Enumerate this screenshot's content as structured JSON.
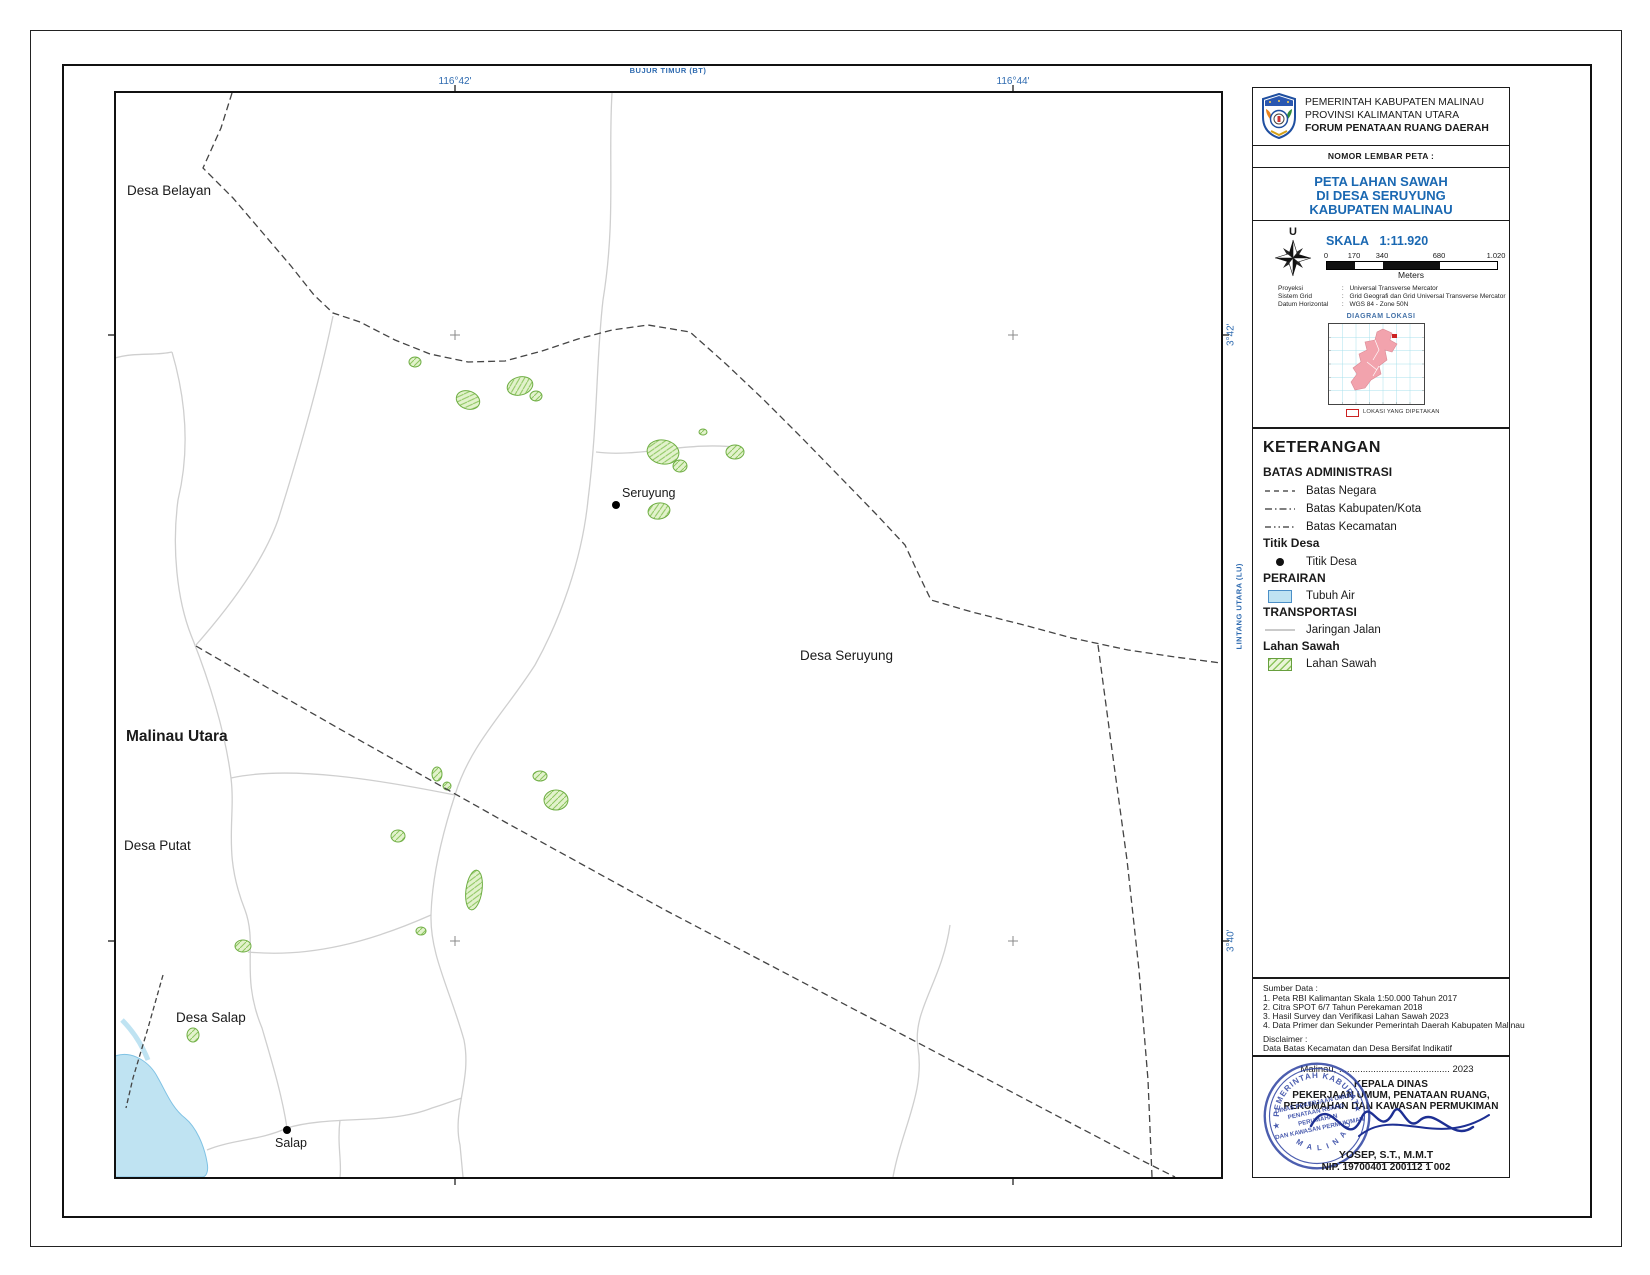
{
  "colors": {
    "title_blue": "#1a68b2",
    "coord_blue": "#2f6bb0",
    "paddy_green": "#7ab648",
    "paddy_fill": "#e2f2cc",
    "water_blue": "#bfe3f2",
    "boundary_gray": "#4a4a4a",
    "road_gray": "#cfcfcf",
    "inset_pink": "#f2a3ad",
    "stamp_blue": "#3448a5",
    "signature_navy": "#1d2f93"
  },
  "axes": {
    "top_label": "BUJUR TIMUR (BT)",
    "right_label": "LINTANG UTARA (LU)",
    "lon_ticks": [
      "116°42'",
      "116°44'"
    ],
    "lat_ticks": [
      "3°42'",
      "3°40'"
    ]
  },
  "map_labels": {
    "desa_belayan": "Desa Belayan",
    "seruyung_point": "Seruyung",
    "desa_seruyung": "Desa Seruyung",
    "malinau_utara": "Malinau Utara",
    "desa_putat": "Desa Putat",
    "desa_salap": "Desa Salap",
    "salap_point": "Salap"
  },
  "header": {
    "agency_line1": "PEMERINTAH KABUPATEN MALINAU",
    "agency_line2": "PROVINSI KALIMANTAN UTARA",
    "agency_line3": "FORUM PENATAAN RUANG DAERAH",
    "sheet_number_label": "NOMOR LEMBAR PETA :"
  },
  "title": {
    "line1": "PETA LAHAN SAWAH",
    "line2": "DI DESA SERUYUNG",
    "line3": "KABUPATEN MALINAU"
  },
  "scale": {
    "north_label": "U",
    "skala_label": "SKALA",
    "skala_value": "1:11.920",
    "bar_ticks": [
      "0",
      "170",
      "340",
      "680",
      "1.020"
    ],
    "unit": "Meters"
  },
  "projection": {
    "separator": ":",
    "rows": [
      {
        "label": "Proyeksi",
        "value": "Universal Transverse Mercator"
      },
      {
        "label": "Sistem Grid",
        "value": "Grid Geografi dan Grid Universal Transverse Mercator"
      },
      {
        "label": "Datum Horizontal",
        "value": "WGS 84 - Zone 50N"
      }
    ]
  },
  "inset": {
    "title": "DIAGRAM LOKASI",
    "legend_label": "LOKASI YANG DIPETAKAN"
  },
  "legend": {
    "title": "KETERANGAN",
    "admin_heading": "BATAS ADMINISTRASI",
    "batas_negara": "Batas Negara",
    "batas_kabupaten": "Batas Kabupaten/Kota",
    "batas_kecamatan": "Batas Kecamatan",
    "titik_desa_heading": "Titik Desa",
    "titik_desa": "Titik Desa",
    "perairan_heading": "PERAIRAN",
    "tubuh_air": "Tubuh Air",
    "transportasi_heading": "TRANSPORTASI",
    "jaringan_jalan": "Jaringan Jalan",
    "lahan_sawah_heading": "Lahan Sawah",
    "lahan_sawah": "Lahan Sawah"
  },
  "sources": {
    "title": "Sumber Data :",
    "items": [
      "1. Peta RBI Kalimantan Skala 1:50.000 Tahun 2017",
      "2. Citra SPOT 6/7 Tahun Perekaman 2018",
      "3. Hasil Survey dan Verifikasi Lahan Sawah 2023",
      "4. Data Primer dan Sekunder Pemerintah Daerah Kabupaten Malinau"
    ],
    "disclaimer_title": "Disclaimer :",
    "disclaimer_text": "Data Batas Kecamatan dan Desa Bersifat Indikatif"
  },
  "signature": {
    "date_line": "Malinau, ..........................................  2023",
    "office_line1": "KEPALA DINAS",
    "office_line2": "PEKERJAAN UMUM, PENATAAN RUANG,",
    "office_line3": "PERUMAHAN DAN KAWASAN PERMUKIMAN",
    "name": "YOSEP, S.T., M.M.T",
    "nip": "NIP. 19700401 200112 1 002",
    "stamp": {
      "arc_top": "PEMERINTAH KABUPATEN",
      "arc_bottom": "M A L I N A U",
      "line1": "DINAS PEKERJAAN UMUM",
      "line2": "PENATAAN RUANG",
      "line3": "PERUMAHAN",
      "line4": "DAN KAWASAN PERMUKIMAN",
      "star": "★"
    }
  }
}
